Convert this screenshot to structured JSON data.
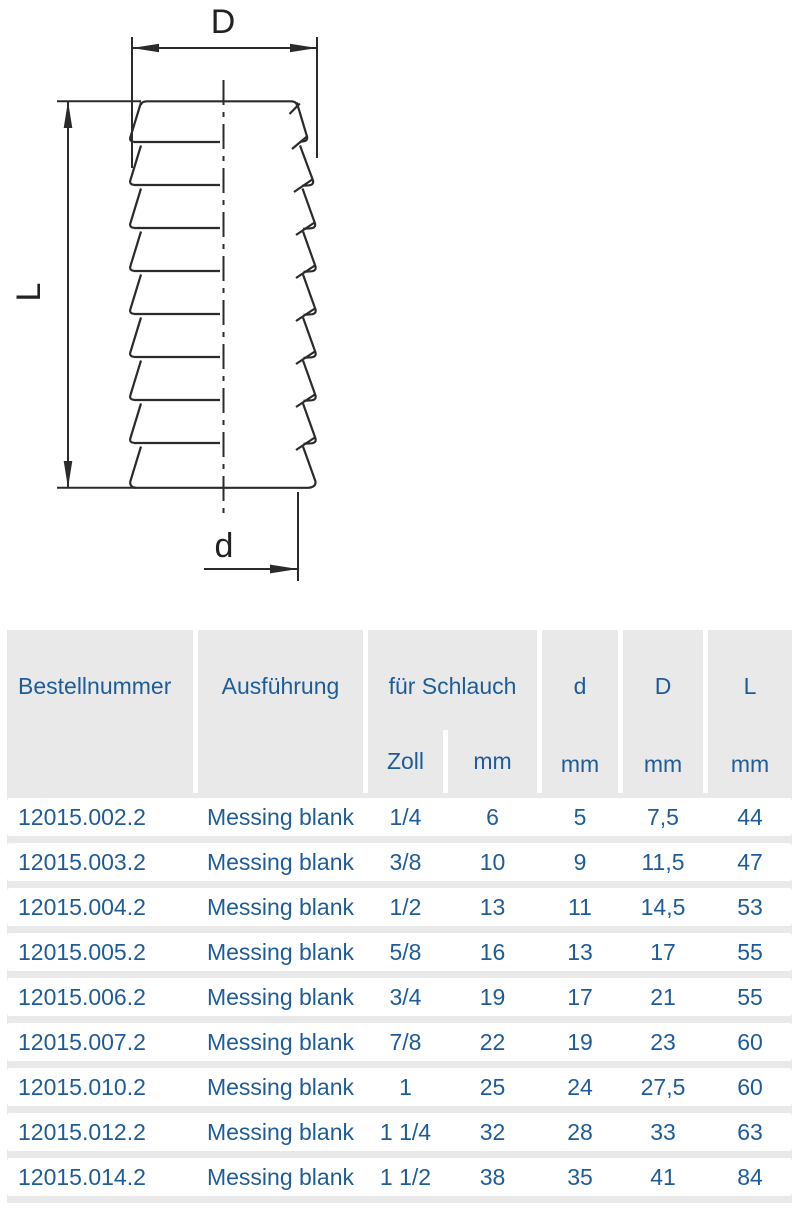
{
  "drawing": {
    "labels": {
      "outer_diameter": "D",
      "length": "L",
      "inner_diameter": "d"
    }
  },
  "table": {
    "columns": [
      {
        "label": "Bestellnummer",
        "unit": ""
      },
      {
        "label": "Ausführung",
        "unit": ""
      },
      {
        "label": "für Schlauch",
        "units": [
          "Zoll",
          "mm"
        ]
      },
      {
        "label": "d",
        "unit": "mm"
      },
      {
        "label": "D",
        "unit": "mm"
      },
      {
        "label": "L",
        "unit": "mm"
      }
    ],
    "rows": [
      [
        "12015.002.2",
        "Messing blank",
        "1/4",
        "6",
        "5",
        "7,5",
        "44"
      ],
      [
        "12015.003.2",
        "Messing blank",
        "3/8",
        "10",
        "9",
        "11,5",
        "47"
      ],
      [
        "12015.004.2",
        "Messing blank",
        "1/2",
        "13",
        "11",
        "14,5",
        "53"
      ],
      [
        "12015.005.2",
        "Messing blank",
        "5/8",
        "16",
        "13",
        "17",
        "55"
      ],
      [
        "12015.006.2",
        "Messing blank",
        "3/4",
        "19",
        "17",
        "21",
        "55"
      ],
      [
        "12015.007.2",
        "Messing blank",
        "7/8",
        "22",
        "19",
        "23",
        "60"
      ],
      [
        "12015.010.2",
        "Messing blank",
        "1",
        "25",
        "24",
        "27,5",
        "60"
      ],
      [
        "12015.012.2",
        "Messing blank",
        "1 1/4",
        "32",
        "28",
        "33",
        "63"
      ],
      [
        "12015.014.2",
        "Messing blank",
        "1 1/2",
        "38",
        "35",
        "41",
        "84"
      ]
    ],
    "colors": {
      "accent_blue": "#1e5c99",
      "header_gray": "#e9e9e9",
      "line_dark": "#2b2b2b"
    }
  }
}
